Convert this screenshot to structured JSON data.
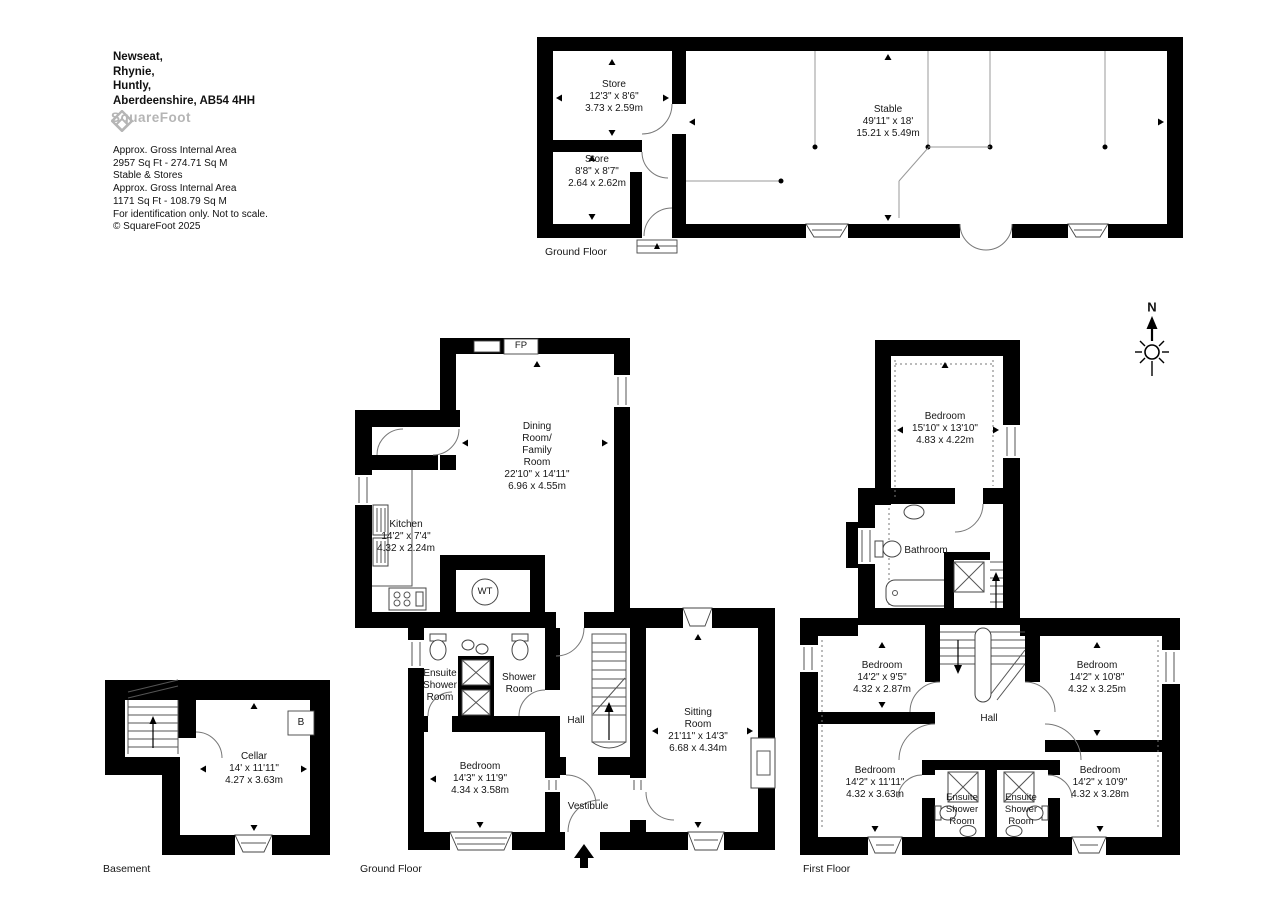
{
  "header": {
    "address_lines": [
      "Newseat,",
      "Rhynie,",
      "Huntly,",
      "Aberdeenshire, AB54 4HH"
    ],
    "logo_text": "SquareFoot",
    "details_lines": [
      "Approx. Gross Internal Area",
      "2957 Sq Ft - 274.71 Sq M",
      "Stable & Stores",
      "Approx. Gross Internal Area",
      "1171 Sq Ft - 108.79 Sq M",
      "For identification only. Not to scale.",
      "© SquareFoot 2025"
    ]
  },
  "compass": {
    "north_label": "N"
  },
  "stable_stores": {
    "floor_label": "Ground Floor",
    "store_1_lines": [
      "Store",
      "12'3\" x 8'6\"",
      "3.73 x 2.59m"
    ],
    "store_2_lines": [
      "Store",
      "8'8\" x 8'7\"",
      "2.64 x 2.62m"
    ],
    "stable_lines": [
      "Stable",
      "49'11\" x 18'",
      "15.21 x 5.49m"
    ]
  },
  "ground_floor": {
    "floor_label": "Ground Floor",
    "dining_lines": [
      "Dining",
      "Room/",
      "Family",
      "Room",
      "22'10\" x 14'11\"",
      "6.96 x 4.55m"
    ],
    "kitchen_lines": [
      "Kitchen",
      "14'2\" x 7'4\"",
      "4.32 x 2.24m"
    ],
    "ensuite_lines": [
      "Ensuite",
      "Shower",
      "Room"
    ],
    "shower_lines": [
      "Shower",
      "Room"
    ],
    "hall_label": "Hall",
    "bedroom_lines": [
      "Bedroom",
      "14'3\" x 11'9\"",
      "4.34 x 3.58m"
    ],
    "vestibule_label": "Vestibule",
    "sitting_lines": [
      "Sitting",
      "Room",
      "21'11\" x 14'3\"",
      "6.68 x 4.34m"
    ],
    "fireplace_label": "FP",
    "water_tank_label": "WT"
  },
  "basement": {
    "floor_label": "Basement",
    "cellar_lines": [
      "Cellar",
      "14' x 11'11\"",
      "4.27 x 3.63m"
    ],
    "boiler_label": "B"
  },
  "first_floor": {
    "floor_label": "First Floor",
    "bedroom_1_lines": [
      "Bedroom",
      "15'10\" x 13'10\"",
      "4.83 x 4.22m"
    ],
    "bathroom_label": "Bathroom",
    "bedroom_2_lines": [
      "Bedroom",
      "14'2\" x 9'5\"",
      "4.32 x 2.87m"
    ],
    "bedroom_3_lines": [
      "Bedroom",
      "14'2\" x 10'8\"",
      "4.32 x 3.25m"
    ],
    "hall_label": "Hall",
    "bedroom_4_lines": [
      "Bedroom",
      "14'2\" x 11'11\"",
      "4.32 x 3.63m"
    ],
    "bedroom_5_lines": [
      "Bedroom",
      "14'2\" x 10'9\"",
      "4.32 x 3.28m"
    ],
    "ensuite_1_lines": [
      "Ensuite",
      "Shower",
      "Room"
    ],
    "ensuite_2_lines": [
      "Ensuite",
      "Shower",
      "Room"
    ]
  },
  "colors": {
    "walls": "#000000",
    "text": "#161616",
    "logo_gray": "#b5b5b5"
  }
}
